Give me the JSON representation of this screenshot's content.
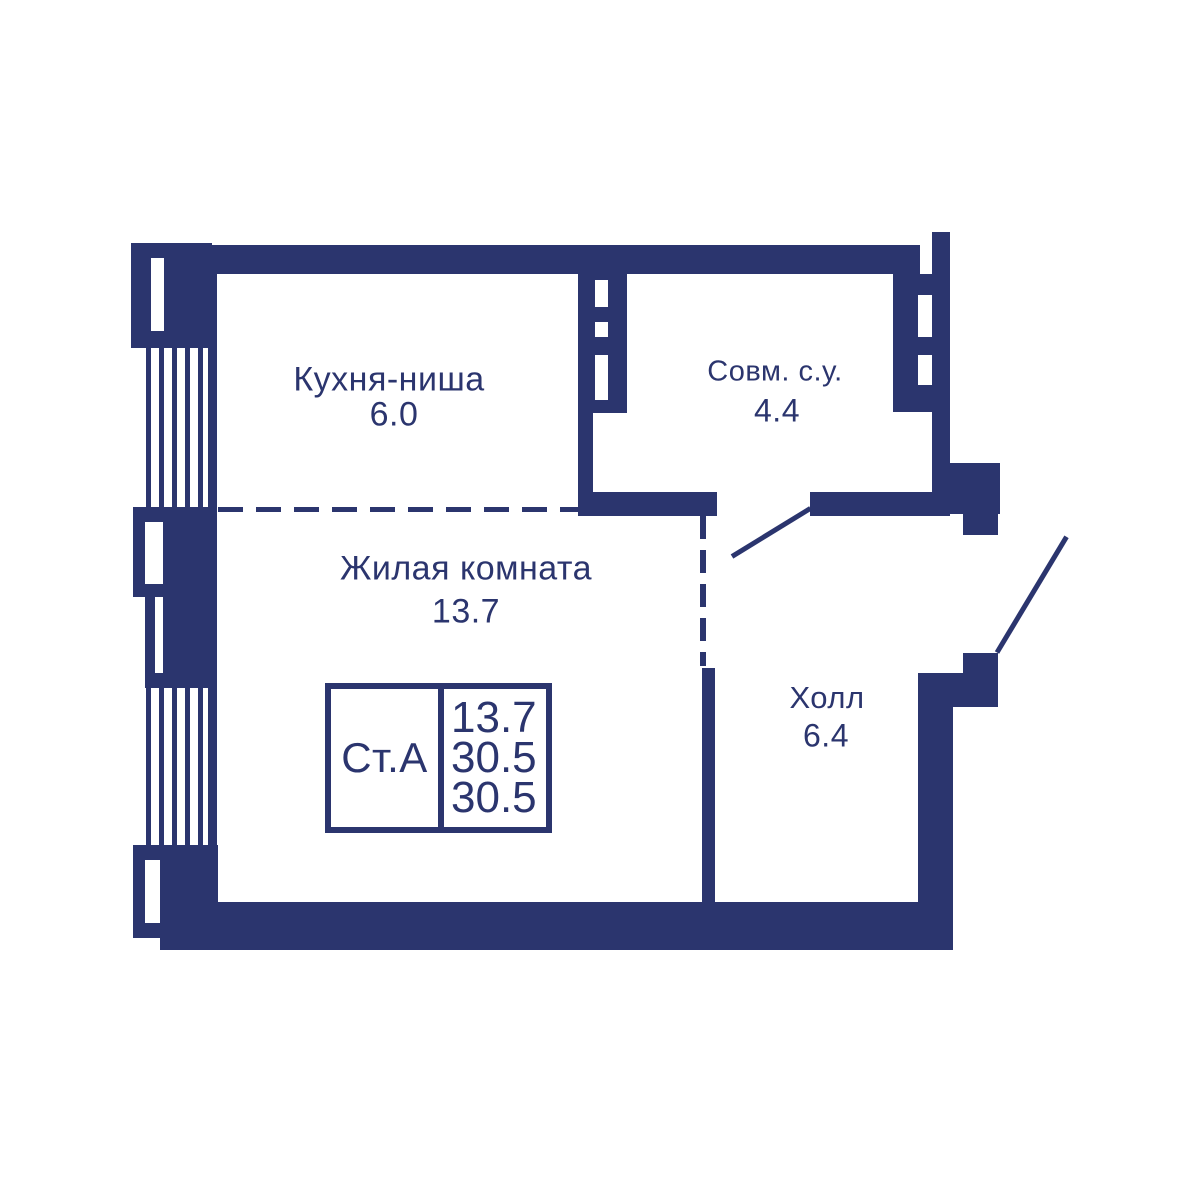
{
  "colors": {
    "wall_navy": "#2b356e",
    "background": "#ffffff"
  },
  "plan": {
    "rooms": [
      {
        "name": "Кухня-ниша",
        "area": "6.0"
      },
      {
        "name": "Совм. с.у.",
        "area": "4.4"
      },
      {
        "name": "Жилая комната",
        "area": "13.7"
      },
      {
        "name": "Холл",
        "area": "6.4"
      }
    ],
    "stamp": {
      "type_label": "Ст.А",
      "living_area": "13.7",
      "area_mid": "30.5",
      "area_total": "30.5"
    }
  }
}
